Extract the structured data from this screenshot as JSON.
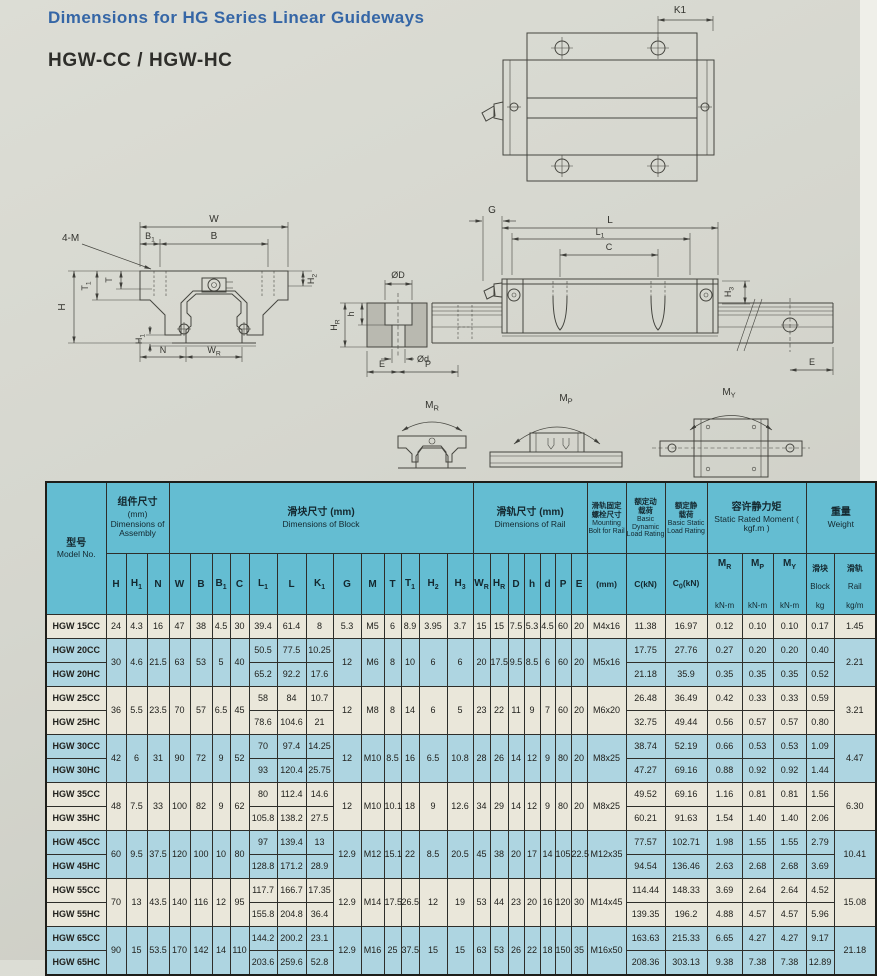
{
  "page": {
    "title": "Dimensions for HG Series Linear Guideways",
    "subtitle": "HGW-CC / HGW-HC"
  },
  "drawings": {
    "top_view": {
      "k1": "K1"
    },
    "front_view": {
      "four_m": "4-M",
      "w": "W",
      "b1": "B_1",
      "b": "B",
      "t": "T",
      "t1": "T_1",
      "h": "H",
      "h1": "H_1",
      "h2": "H_2",
      "n": "N",
      "wr": "W_R"
    },
    "side_view": {
      "g": "G",
      "l": "L",
      "l1": "L_1",
      "c": "C",
      "h3": "H_3",
      "od": "ØD",
      "odl": "Ød",
      "hsmall": "h",
      "hr": "H_R",
      "e_left": "E",
      "p": "P",
      "e_right": "E"
    },
    "moments": {
      "mr": "M_R",
      "mp": "M_P",
      "my": "M_Y"
    }
  },
  "table": {
    "header": {
      "model_cn": "型号",
      "model_en": "Model No.",
      "assembly_cn": "组件尺寸",
      "assembly_mm": "(mm)",
      "assembly_en": "Dimensions of Assembly",
      "block_cn": "滑块尺寸 (mm)",
      "block_en": "Dimensions of Block",
      "rail_cn": "滑轨尺寸 (mm)",
      "rail_en": "Dimensions of Rail",
      "bolt_cn": "滑轨固定\n螺栓尺寸",
      "bolt_en": "Mounting Bolt for Rail",
      "bolt_unit": "(mm)",
      "dyn_cn": "额定动\n载荷",
      "dyn_en": "Basic Dynamic Load Rating",
      "dyn_unit": "C(kN)",
      "stat_cn": "额定静\n载荷",
      "stat_en": "Basic Static Load Rating",
      "stat_unit": "C_0(kN)",
      "moment_cn": "容许静力矩",
      "moment_en": "Static Rated Moment ( kgf.m )",
      "weight_cn": "重量",
      "weight_en": "Weight",
      "cols": [
        "H",
        "H_1",
        "N",
        "W",
        "B",
        "B_1",
        "C",
        "L_1",
        "L",
        "K_1",
        "G",
        "M",
        "T",
        "T_1",
        "H_2",
        "H_3",
        "W_R",
        "H_R",
        "D",
        "h",
        "d",
        "P",
        "E"
      ],
      "moment_cols": [
        {
          "label": "M_R",
          "unit": "kN-m"
        },
        {
          "label": "M_P",
          "unit": "kN-m"
        },
        {
          "label": "M_Y",
          "unit": "kN-m"
        }
      ],
      "weight_cols": [
        {
          "cn": "滑块",
          "en": "Block",
          "unit": "kg"
        },
        {
          "cn": "滑轨",
          "en": "Rail",
          "unit": "kg/m"
        }
      ]
    },
    "groups": [
      {
        "tint": "cream",
        "shared": {
          "H": "24",
          "H1": "4.3",
          "N": "16",
          "W": "47",
          "B": "38",
          "B1": "4.5",
          "C": "30",
          "G": "5.3",
          "M": "M5",
          "T": "6",
          "T1": "8.9",
          "H2": "3.95",
          "H3": "3.7",
          "WR": "15",
          "HR": "15",
          "D": "7.5",
          "h": "5.3",
          "d": "4.5",
          "P": "60",
          "E": "20",
          "bolt": "M4x16",
          "rail": "1.45"
        },
        "rows": [
          {
            "model": "HGW 15CC",
            "L1": "39.4",
            "L": "61.4",
            "K1": "8",
            "C": "11.38",
            "C0": "16.97",
            "MR": "0.12",
            "MP": "0.10",
            "MY": "0.10",
            "block": "0.17"
          }
        ]
      },
      {
        "tint": "blue",
        "shared": {
          "H": "30",
          "H1": "4.6",
          "N": "21.5",
          "W": "63",
          "B": "53",
          "B1": "5",
          "C": "40",
          "G": "12",
          "M": "M6",
          "T": "8",
          "T1": "10",
          "H2": "6",
          "H3": "6",
          "WR": "20",
          "HR": "17.5",
          "D": "9.5",
          "h": "8.5",
          "d": "6",
          "P": "60",
          "E": "20",
          "bolt": "M5x16",
          "rail": "2.21"
        },
        "rows": [
          {
            "model": "HGW 20CC",
            "L1": "50.5",
            "L": "77.5",
            "K1": "10.25",
            "C": "17.75",
            "C0": "27.76",
            "MR": "0.27",
            "MP": "0.20",
            "MY": "0.20",
            "block": "0.40"
          },
          {
            "model": "HGW 20HC",
            "L1": "65.2",
            "L": "92.2",
            "K1": "17.6",
            "C": "21.18",
            "C0": "35.9",
            "MR": "0.35",
            "MP": "0.35",
            "MY": "0.35",
            "block": "0.52"
          }
        ]
      },
      {
        "tint": "cream",
        "shared": {
          "H": "36",
          "H1": "5.5",
          "N": "23.5",
          "W": "70",
          "B": "57",
          "B1": "6.5",
          "C": "45",
          "G": "12",
          "M": "M8",
          "T": "8",
          "T1": "14",
          "H2": "6",
          "H3": "5",
          "WR": "23",
          "HR": "22",
          "D": "11",
          "h": "9",
          "d": "7",
          "P": "60",
          "E": "20",
          "bolt": "M6x20",
          "rail": "3.21"
        },
        "rows": [
          {
            "model": "HGW 25CC",
            "L1": "58",
            "L": "84",
            "K1": "10.7",
            "C": "26.48",
            "C0": "36.49",
            "MR": "0.42",
            "MP": "0.33",
            "MY": "0.33",
            "block": "0.59"
          },
          {
            "model": "HGW 25HC",
            "L1": "78.6",
            "L": "104.6",
            "K1": "21",
            "C": "32.75",
            "C0": "49.44",
            "MR": "0.56",
            "MP": "0.57",
            "MY": "0.57",
            "block": "0.80"
          }
        ]
      },
      {
        "tint": "blue",
        "shared": {
          "H": "42",
          "H1": "6",
          "N": "31",
          "W": "90",
          "B": "72",
          "B1": "9",
          "C": "52",
          "G": "12",
          "M": "M10",
          "T": "8.5",
          "T1": "16",
          "H2": "6.5",
          "H3": "10.8",
          "WR": "28",
          "HR": "26",
          "D": "14",
          "h": "12",
          "d": "9",
          "P": "80",
          "E": "20",
          "bolt": "M8x25",
          "rail": "4.47"
        },
        "rows": [
          {
            "model": "HGW 30CC",
            "L1": "70",
            "L": "97.4",
            "K1": "14.25",
            "C": "38.74",
            "C0": "52.19",
            "MR": "0.66",
            "MP": "0.53",
            "MY": "0.53",
            "block": "1.09"
          },
          {
            "model": "HGW 30HC",
            "L1": "93",
            "L": "120.4",
            "K1": "25.75",
            "C": "47.27",
            "C0": "69.16",
            "MR": "0.88",
            "MP": "0.92",
            "MY": "0.92",
            "block": "1.44"
          }
        ]
      },
      {
        "tint": "cream",
        "shared": {
          "H": "48",
          "H1": "7.5",
          "N": "33",
          "W": "100",
          "B": "82",
          "B1": "9",
          "C": "62",
          "G": "12",
          "M": "M10",
          "T": "10.1",
          "T1": "18",
          "H2": "9",
          "H3": "12.6",
          "WR": "34",
          "HR": "29",
          "D": "14",
          "h": "12",
          "d": "9",
          "P": "80",
          "E": "20",
          "bolt": "M8x25",
          "rail": "6.30"
        },
        "rows": [
          {
            "model": "HGW 35CC",
            "L1": "80",
            "L": "112.4",
            "K1": "14.6",
            "C": "49.52",
            "C0": "69.16",
            "MR": "1.16",
            "MP": "0.81",
            "MY": "0.81",
            "block": "1.56"
          },
          {
            "model": "HGW 35HC",
            "L1": "105.8",
            "L": "138.2",
            "K1": "27.5",
            "C": "60.21",
            "C0": "91.63",
            "MR": "1.54",
            "MP": "1.40",
            "MY": "1.40",
            "block": "2.06"
          }
        ]
      },
      {
        "tint": "blue",
        "shared": {
          "H": "60",
          "H1": "9.5",
          "N": "37.5",
          "W": "120",
          "B": "100",
          "B1": "10",
          "C": "80",
          "G": "12.9",
          "M": "M12",
          "T": "15.1",
          "T1": "22",
          "H2": "8.5",
          "H3": "20.5",
          "WR": "45",
          "HR": "38",
          "D": "20",
          "h": "17",
          "d": "14",
          "P": "105",
          "E": "22.5",
          "bolt": "M12x35",
          "rail": "10.41"
        },
        "rows": [
          {
            "model": "HGW 45CC",
            "L1": "97",
            "L": "139.4",
            "K1": "13",
            "C": "77.57",
            "C0": "102.71",
            "MR": "1.98",
            "MP": "1.55",
            "MY": "1.55",
            "block": "2.79"
          },
          {
            "model": "HGW 45HC",
            "L1": "128.8",
            "L": "171.2",
            "K1": "28.9",
            "C": "94.54",
            "C0": "136.46",
            "MR": "2.63",
            "MP": "2.68",
            "MY": "2.68",
            "block": "3.69"
          }
        ]
      },
      {
        "tint": "cream",
        "shared": {
          "H": "70",
          "H1": "13",
          "N": "43.5",
          "W": "140",
          "B": "116",
          "B1": "12",
          "C": "95",
          "G": "12.9",
          "M": "M14",
          "T": "17.5",
          "T1": "26.5",
          "H2": "12",
          "H3": "19",
          "WR": "53",
          "HR": "44",
          "D": "23",
          "h": "20",
          "d": "16",
          "P": "120",
          "E": "30",
          "bolt": "M14x45",
          "rail": "15.08"
        },
        "rows": [
          {
            "model": "HGW 55CC",
            "L1": "117.7",
            "L": "166.7",
            "K1": "17.35",
            "C": "114.44",
            "C0": "148.33",
            "MR": "3.69",
            "MP": "2.64",
            "MY": "2.64",
            "block": "4.52"
          },
          {
            "model": "HGW 55HC",
            "L1": "155.8",
            "L": "204.8",
            "K1": "36.4",
            "C": "139.35",
            "C0": "196.2",
            "MR": "4.88",
            "MP": "4.57",
            "MY": "4.57",
            "block": "5.96"
          }
        ]
      },
      {
        "tint": "blue",
        "shared": {
          "H": "90",
          "H1": "15",
          "N": "53.5",
          "W": "170",
          "B": "142",
          "B1": "14",
          "C": "110",
          "G": "12.9",
          "M": "M16",
          "T": "25",
          "T1": "37.5",
          "H2": "15",
          "H3": "15",
          "WR": "63",
          "HR": "53",
          "D": "26",
          "h": "22",
          "d": "18",
          "P": "150",
          "E": "35",
          "bolt": "M16x50",
          "rail": "21.18"
        },
        "rows": [
          {
            "model": "HGW 65CC",
            "L1": "144.2",
            "L": "200.2",
            "K1": "23.1",
            "C": "163.63",
            "C0": "215.33",
            "MR": "6.65",
            "MP": "4.27",
            "MY": "4.27",
            "block": "9.17"
          },
          {
            "model": "HGW 65HC",
            "L1": "203.6",
            "L": "259.6",
            "K1": "52.8",
            "C": "208.36",
            "C0": "303.13",
            "MR": "9.38",
            "MP": "7.38",
            "MY": "7.38",
            "block": "12.89"
          }
        ]
      }
    ]
  }
}
